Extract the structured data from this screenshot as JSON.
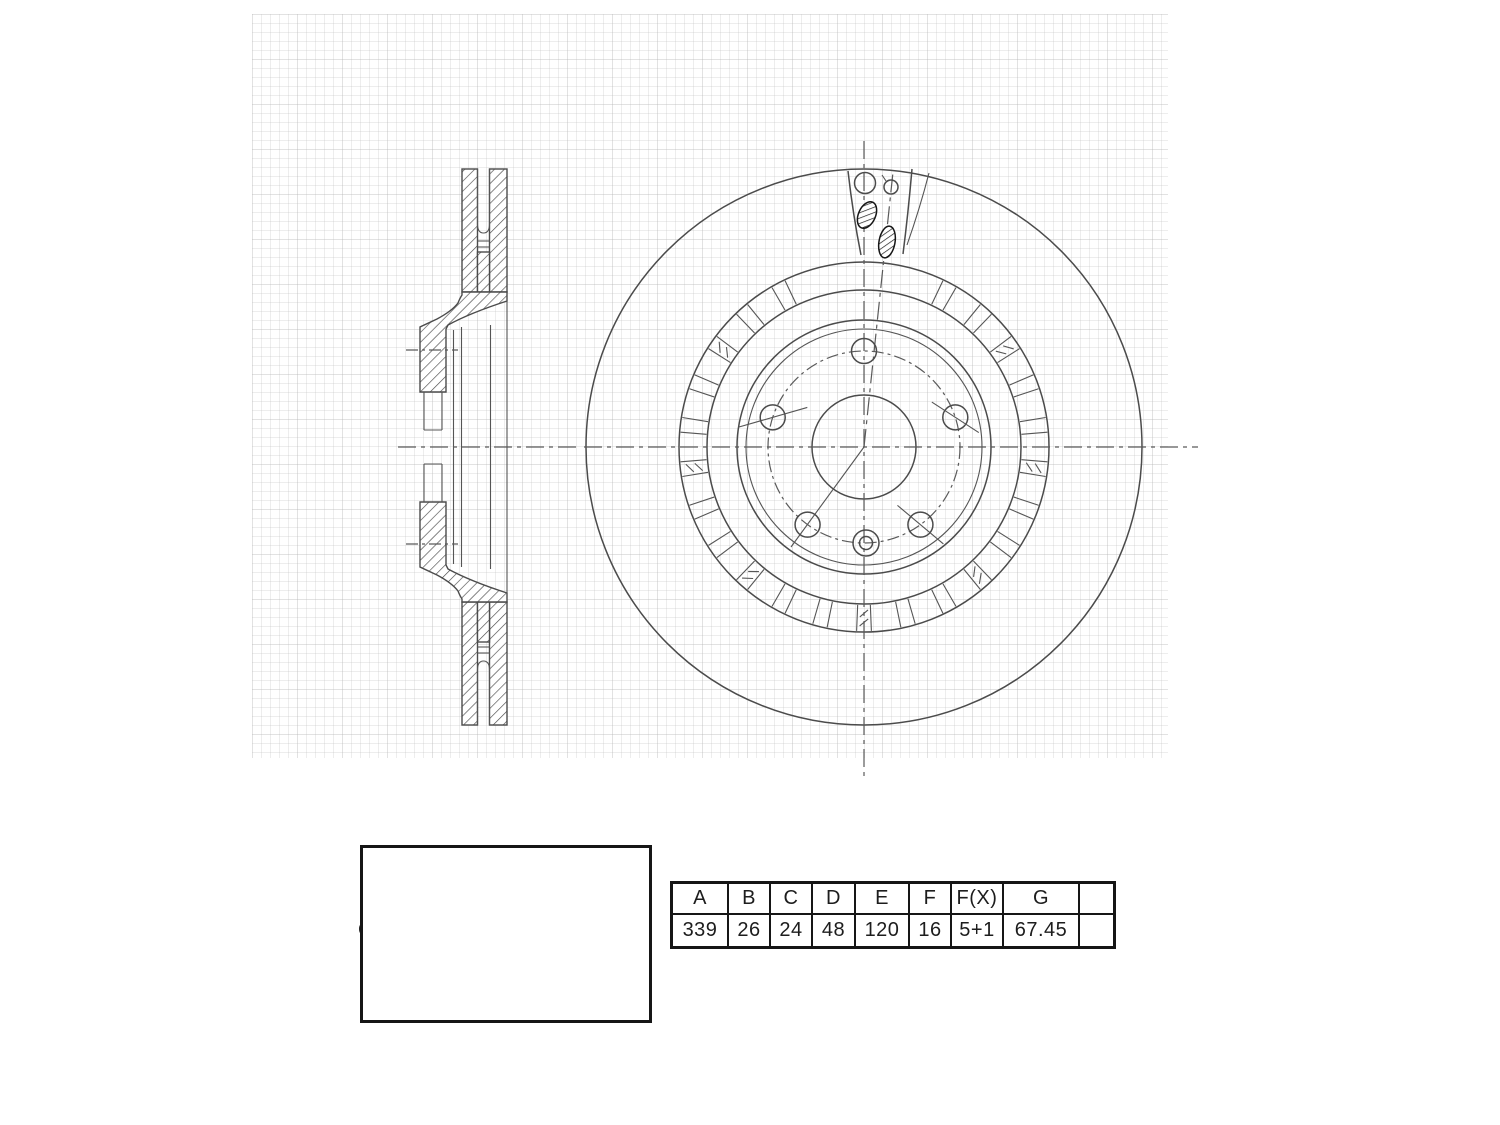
{
  "drawing": {
    "title": "vented brake disc / rotor engineering drawing",
    "views": [
      "side cross-section",
      "front view",
      "dimension key diagram"
    ]
  },
  "labels": {
    "a": "A",
    "b": "B",
    "c_min": "C(MIN)",
    "d": "D",
    "e": "E",
    "f": "F",
    "f_x": "F(X)",
    "g": "G"
  },
  "spec_table": {
    "headers": [
      "A",
      "B",
      "C",
      "D",
      "E",
      "F",
      "F(X)",
      "G",
      ""
    ],
    "values": [
      "339",
      "26",
      "24",
      "48",
      "120",
      "16",
      "5+1",
      "67.45",
      ""
    ]
  },
  "colors": {
    "line": "#4b4b4b",
    "dark_line": "#161616",
    "grid": "#bebebe",
    "text": "#1d1d1d",
    "background": "#ffffff"
  }
}
